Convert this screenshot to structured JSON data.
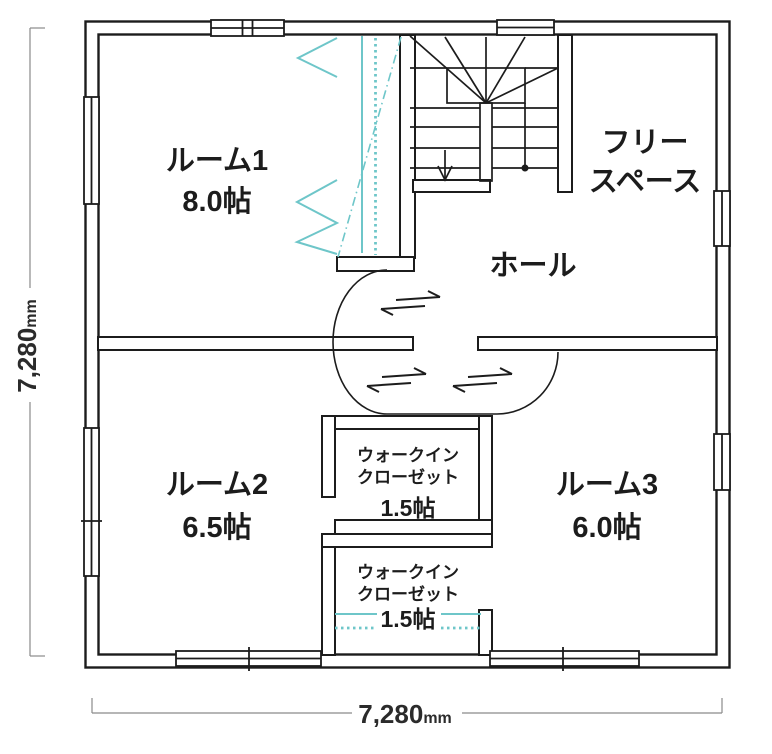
{
  "plan": {
    "rooms": {
      "room1": {
        "name": "ルーム1",
        "area": "8.0帖"
      },
      "room2": {
        "name": "ルーム2",
        "area": "6.5帖"
      },
      "room3": {
        "name": "ルーム3",
        "area": "6.0帖"
      },
      "hall": {
        "name": "ホール"
      },
      "free_space": {
        "name_line1": "フリー",
        "name_line2": "スペース"
      },
      "closet1": {
        "name_line1": "ウォークイン",
        "name_line2": "クローゼット",
        "area": "1.5帖"
      },
      "closet2": {
        "name_line1": "ウォークイン",
        "name_line2": "クローゼット",
        "area": "1.5帖"
      }
    },
    "dimensions": {
      "vertical": {
        "value": "7,280",
        "unit": "mm"
      },
      "horizontal": {
        "value": "7,280",
        "unit": "mm"
      }
    },
    "symbols": {
      "stairs": "winder-staircase-down-arrow",
      "sliding_doors": 3,
      "folding_closet_doors": "teal-chevrons"
    },
    "colors": {
      "wall": "#1c1c1c",
      "closet_accent": "#6ec6c9",
      "dimension_line": "#8a8a8a",
      "background": "#ffffff"
    }
  }
}
